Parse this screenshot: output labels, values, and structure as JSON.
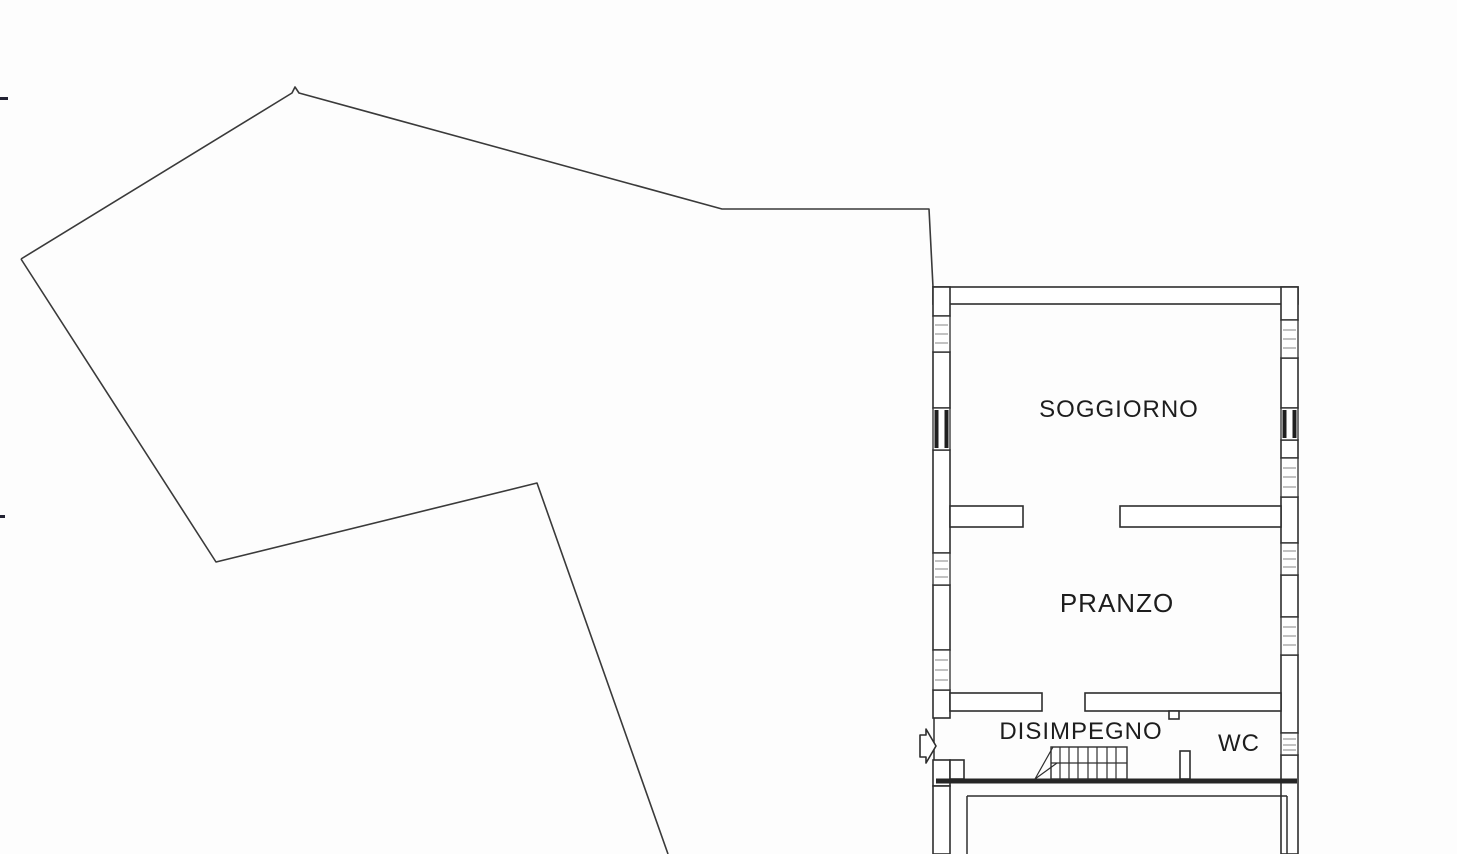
{
  "meta": {
    "kind": "scanned architectural floor plan",
    "page_background": "#fdfdfd"
  },
  "colors": {
    "line": "#2e2e2e",
    "boundary_line": "#3a3a3a",
    "window_hatch": "#9a9a9a",
    "label_text": "#1d1d1d"
  },
  "rooms": {
    "soggiorno": {
      "label": "SOGGIORNO"
    },
    "pranzo": {
      "label": "PRANZO"
    },
    "disimpegno": {
      "label": "DISIMPEGNO"
    },
    "wc": {
      "label": "WC"
    }
  },
  "symbols": {
    "entrance_arrow": "right-pointing block arrow at entrance door",
    "staircase": "stair treads with diagonal break line",
    "window": "wall opening with hatched sill",
    "terrace_boundary": "unlabeled open polygon (terrace / garden edge)",
    "scan_marks": "two small dark registration ticks on left paper edge"
  }
}
